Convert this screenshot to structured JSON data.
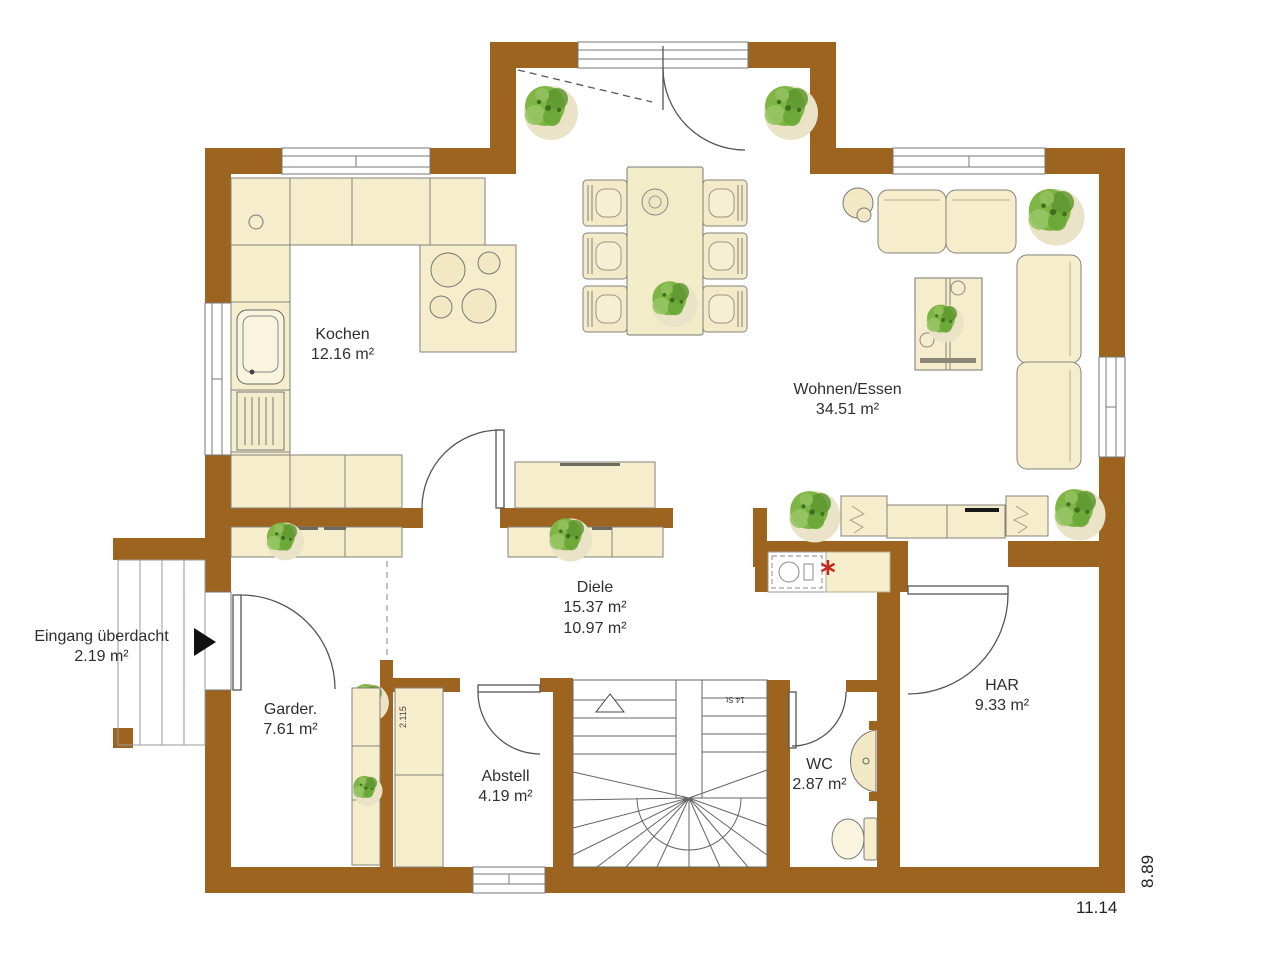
{
  "floorplan": {
    "rooms": [
      {
        "name": "Kochen",
        "area": "12.16 m²"
      },
      {
        "name": "Wohnen/Essen",
        "area": "34.51 m²"
      },
      {
        "name": "Diele",
        "area": "15.37 m²",
        "area2": "10.97 m²"
      },
      {
        "name": "Eingang überdacht",
        "area": "2.19 m²"
      },
      {
        "name": "Garder.",
        "area": "7.61 m²"
      },
      {
        "name": "Abstell",
        "area": "4.19 m²"
      },
      {
        "name": "WC",
        "area": "2.87 m²"
      },
      {
        "name": "HAR",
        "area": "9.33 m²"
      }
    ],
    "dimensions": {
      "overall_width": "11.14",
      "overall_depth": "8.89"
    },
    "annotations": {
      "stair_steps": "14 St",
      "cabinet_depth": "2.115"
    },
    "colors": {
      "wall_brown": "#9D6420",
      "furniture_cream": "#F5EDCC",
      "plant_green": "#7FB544",
      "marker_red": "#C4271B"
    }
  }
}
